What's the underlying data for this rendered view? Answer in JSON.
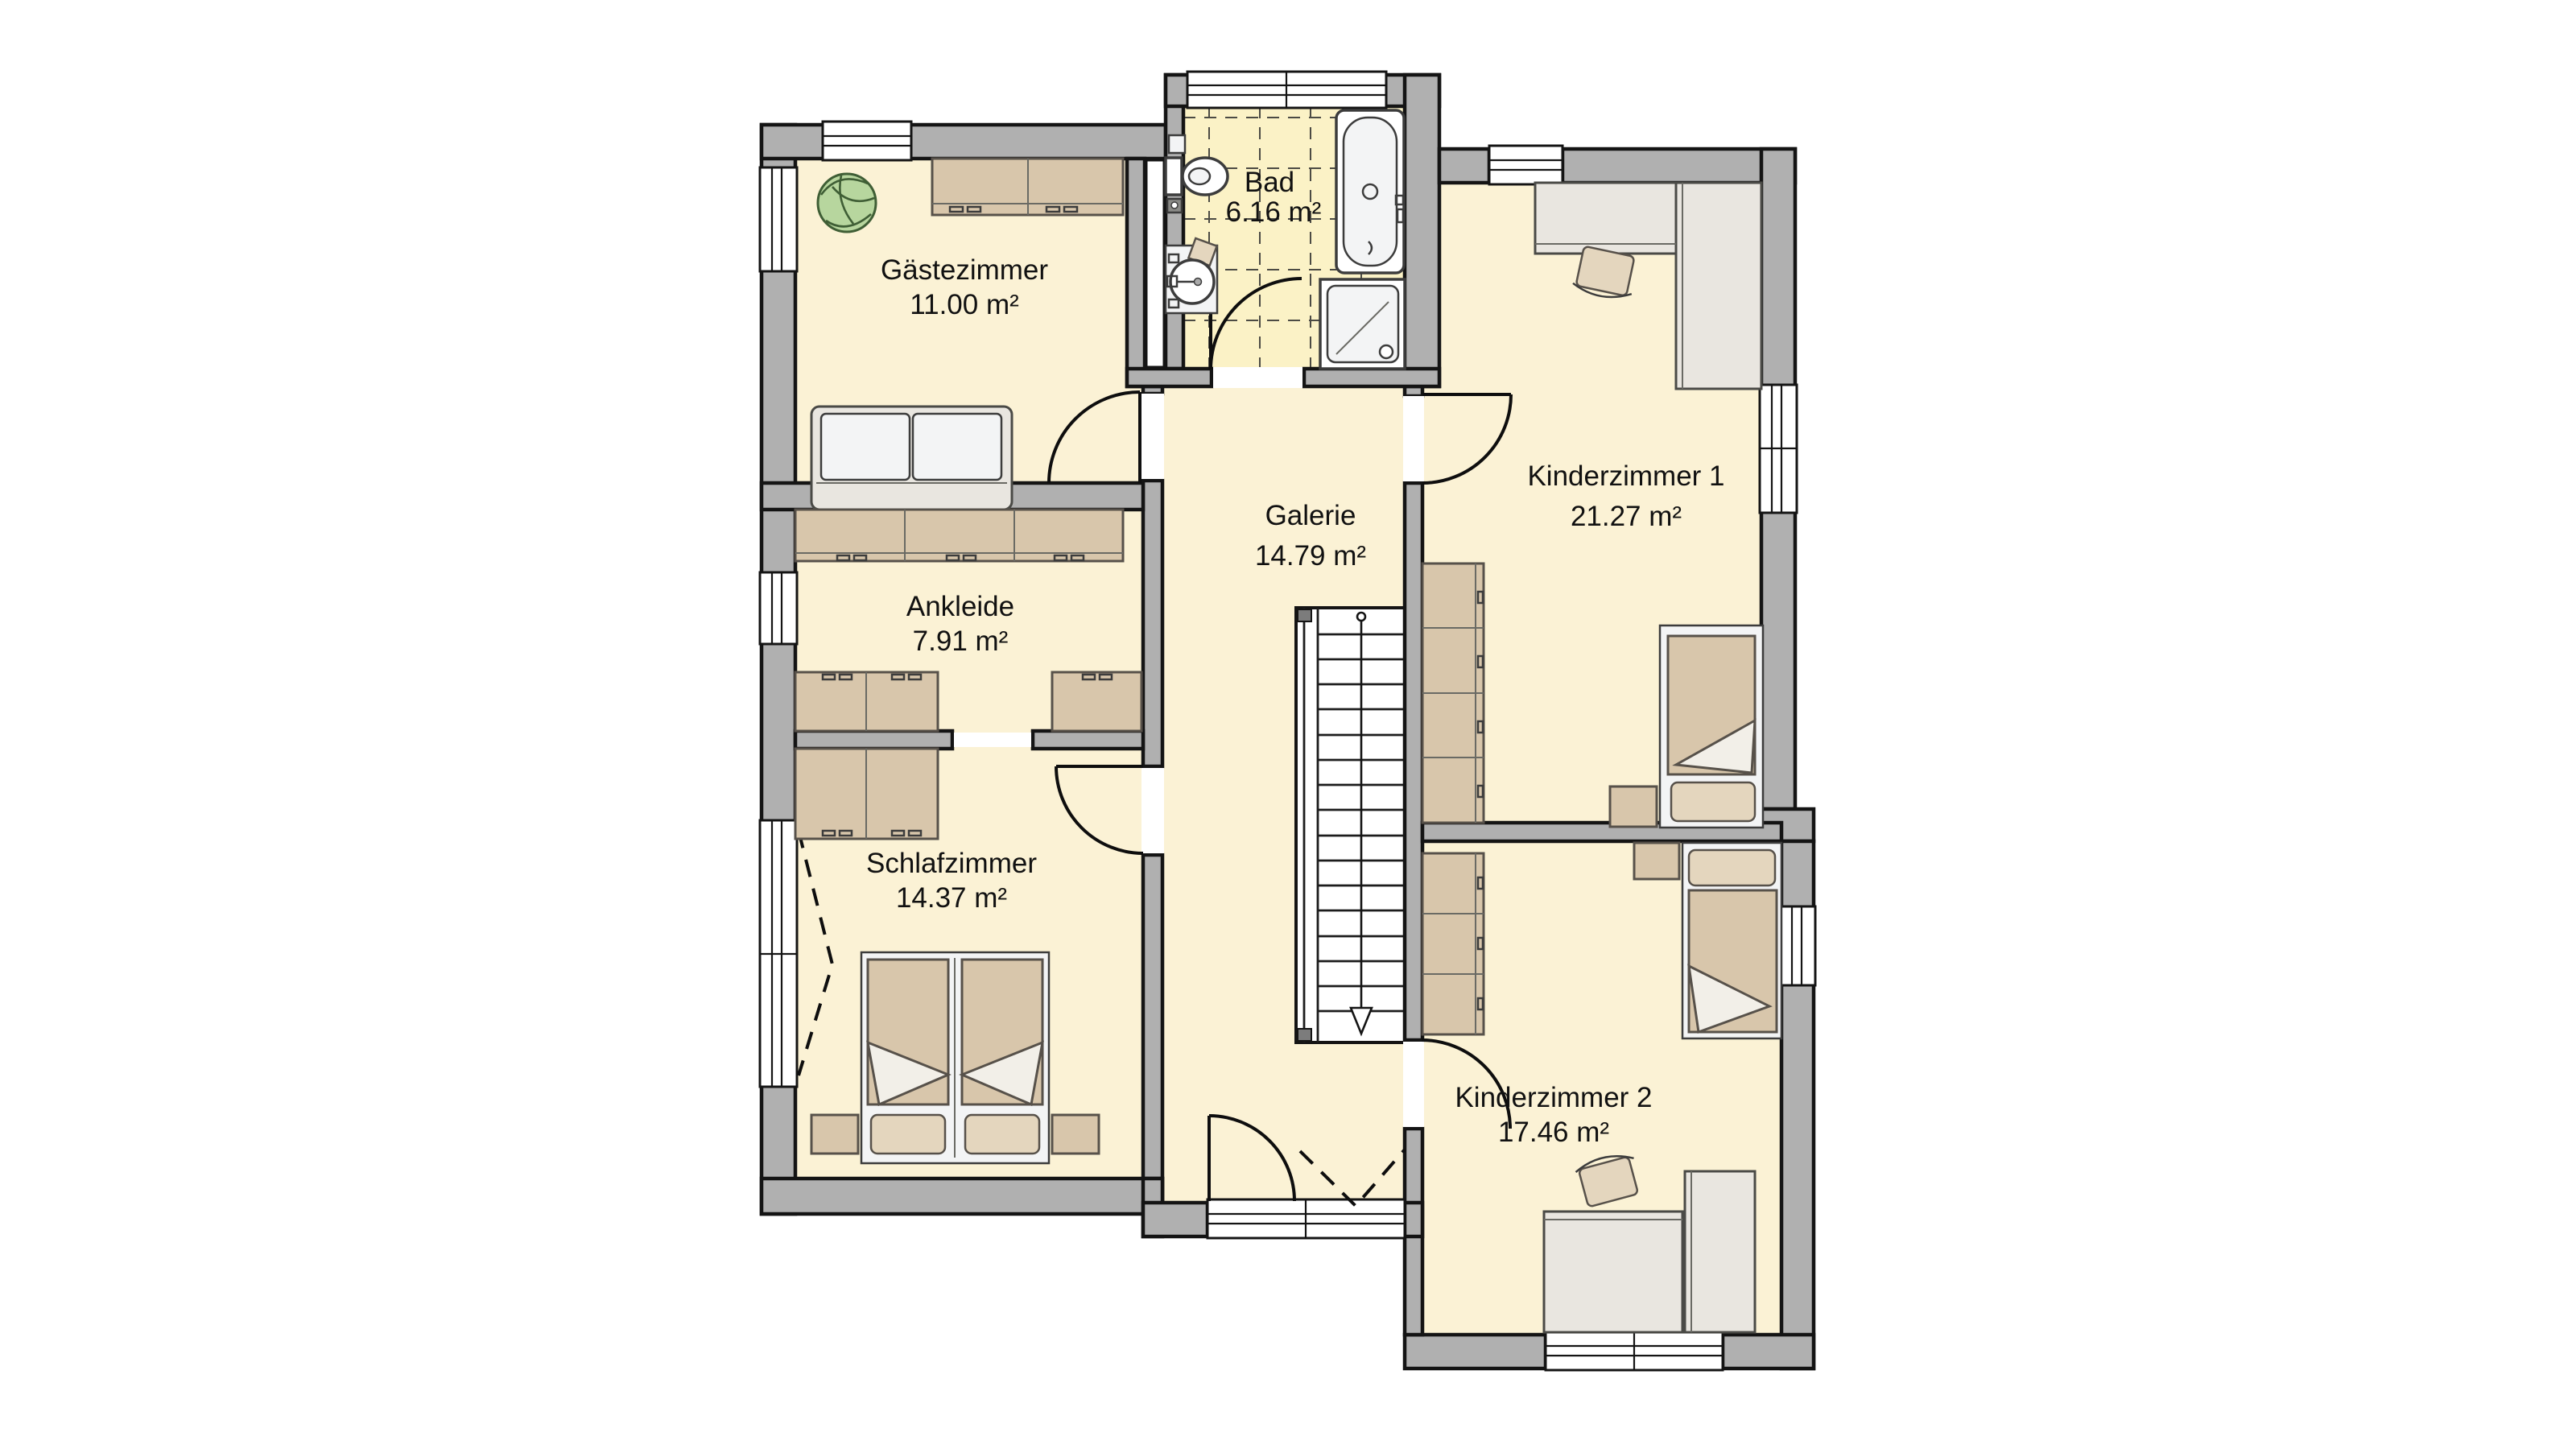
{
  "rooms": [
    {
      "name": "Gästezimmer",
      "area": "11.00 m²"
    },
    {
      "name": "Bad",
      "area": "6.16 m²"
    },
    {
      "name": "Kinderzimmer 1",
      "area": "21.27 m²"
    },
    {
      "name": "Galerie",
      "area": "14.79 m²"
    },
    {
      "name": "Ankleide",
      "area": "7.91 m²"
    },
    {
      "name": "Schlafzimmer",
      "area": "14.37 m²"
    },
    {
      "name": "Kinderzimmer 2",
      "area": "17.46 m²"
    }
  ],
  "colors": {
    "floor": "#FBF2D5",
    "bath_floor": "#FBF2C6",
    "wall": "#B0B0B0",
    "furniture_tan": "#D8C6AB",
    "furniture_tan_light": "#E4D6BE",
    "furniture_gray": "#E9E6E0",
    "plant_green": "#B7D69E"
  },
  "icons": [
    "staircase",
    "bathtub",
    "shower",
    "toilet",
    "washbasin",
    "double-bed",
    "single-bed",
    "wardrobe",
    "desk",
    "chair",
    "sofa",
    "plant",
    "door-swing",
    "window",
    "down-arrow"
  ]
}
